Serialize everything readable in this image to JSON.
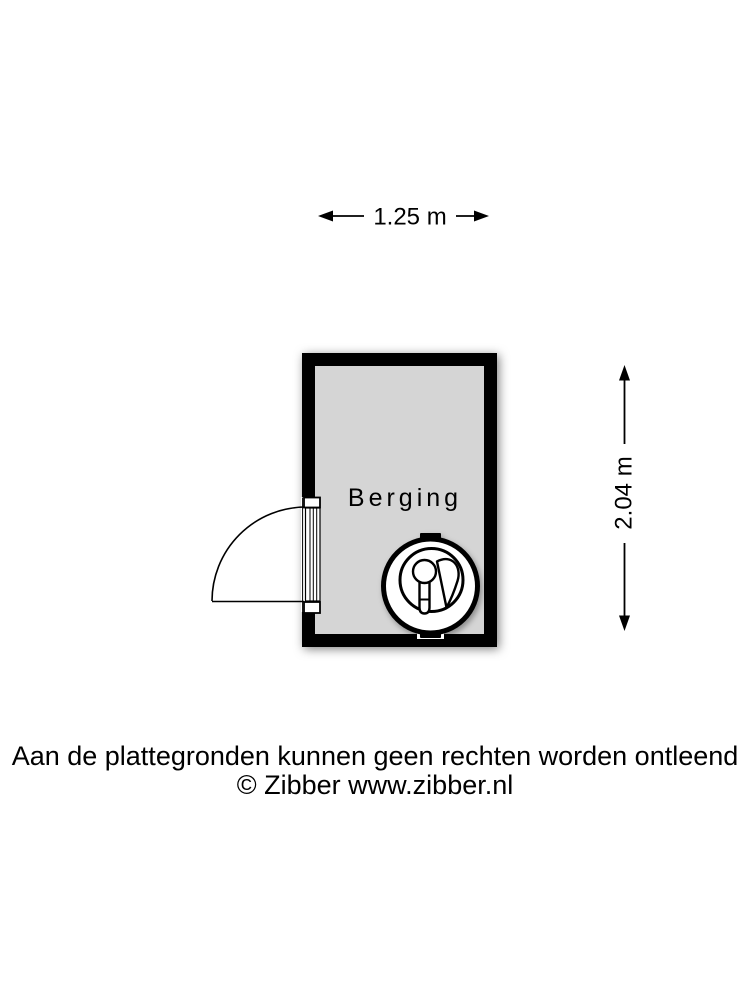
{
  "floorplan": {
    "room": {
      "label": "Berging"
    },
    "dimensions": {
      "width_label": "1.25 m",
      "height_label": "2.04 m"
    },
    "appliance": {
      "icon": "washing-machine-icon"
    },
    "colors": {
      "wall": "#000000",
      "floor": "#d5d5d5",
      "line": "#000000",
      "background": "#ffffff"
    }
  },
  "footer": {
    "disclaimer": "Aan de plattegronden kunnen geen rechten worden ontleend",
    "copyright": "© Zibber www.zibber.nl"
  }
}
